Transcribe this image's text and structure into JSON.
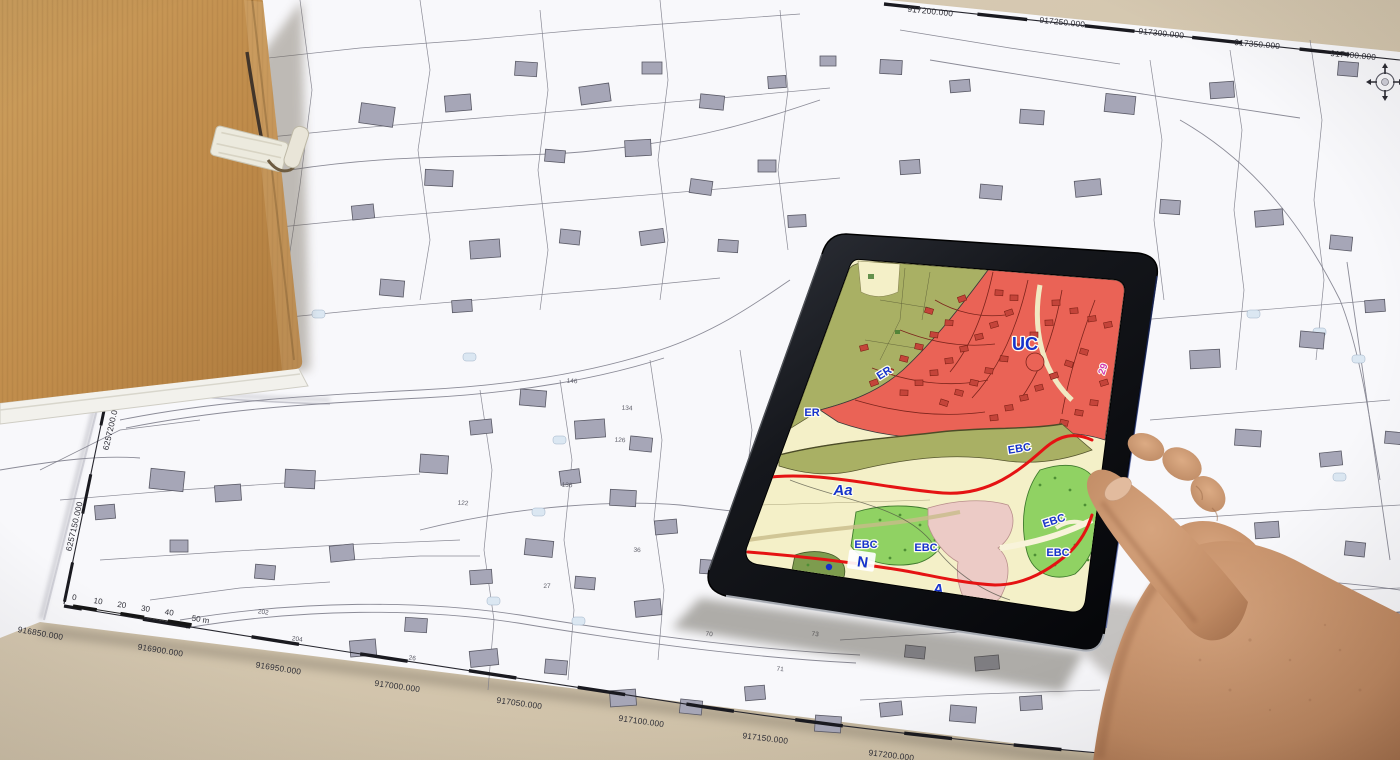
{
  "colors": {
    "desk": "#d5c8b2",
    "paper": "#f8f8fb",
    "folder_cardboard": "#c3914f",
    "tablet_bezel": "#111318",
    "zone_residential_red": "#ea6356",
    "zone_olive_green": "#a9b064",
    "zone_nature_green": "#90d263",
    "zone_agricultural_yellow": "#f4f0c8",
    "zone_pink": "#eccbc6",
    "boundary_line_red": "#e51313",
    "zone_label_blue": "#1733cc",
    "parcel_ref_magenta": "#d23bb0",
    "building_gray": "#a6a6b7",
    "skin": "#c08a67"
  },
  "upper_sheet": {
    "top_coordinates": [
      "917200.000",
      "917250.000",
      "917300.000",
      "917350.000",
      "917400.000"
    ]
  },
  "lower_sheet": {
    "bottom_coordinates": [
      "916850.000",
      "916900.000",
      "916950.000",
      "917000.000",
      "917050.000",
      "917100.000",
      "917150.000",
      "917200.000"
    ],
    "left_coordinates": [
      "6257200.000",
      "6257150.000"
    ],
    "scale_bar": {
      "ticks": [
        "0",
        "10",
        "20",
        "30",
        "40"
      ],
      "end_label": "50 m"
    }
  },
  "parcel_numbers": [
    "122",
    "126",
    "134",
    "136",
    "146",
    "26",
    "27",
    "36",
    "70",
    "71",
    "73",
    "22",
    "3",
    "8",
    "10",
    "202",
    "204"
  ],
  "tablet_map": {
    "zone_labels": {
      "uc": "UC",
      "er_upper": "ER",
      "er_lower": "ER",
      "aa": "Aa",
      "n": "N",
      "a": "A",
      "ebc_1": "EBC",
      "ebc_2": "EBC",
      "ebc_3": "EBC",
      "ebc_4": "EBC",
      "ebc_5": "EBC",
      "parcel_ref": "29"
    }
  }
}
